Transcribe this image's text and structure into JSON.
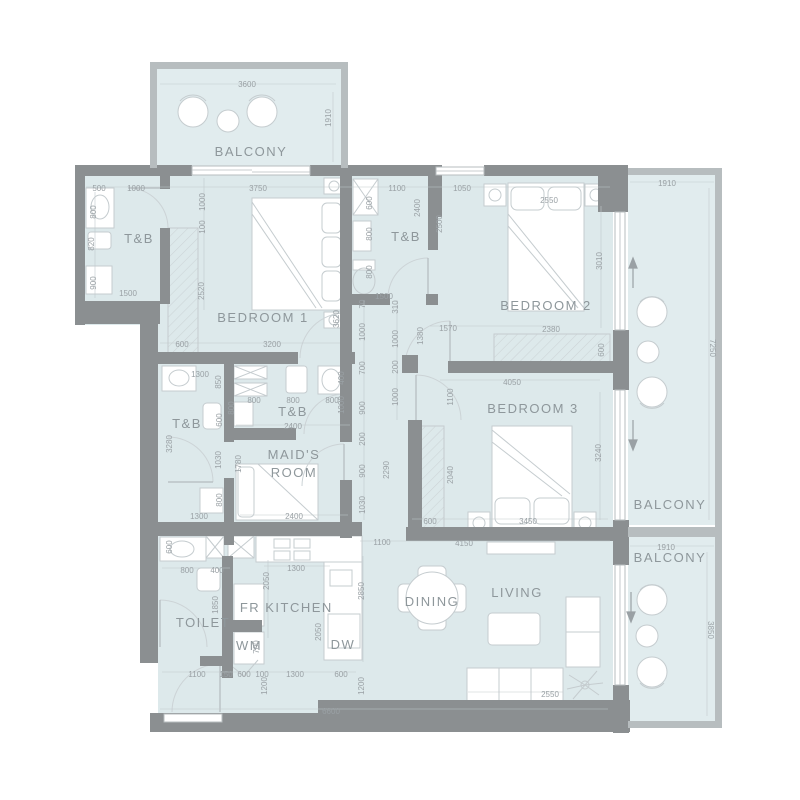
{
  "title": "apartment-floor-plan",
  "colors": {
    "wall": "#8b8f91",
    "balcony_wall": "#b7bdbf",
    "room_fill": "#dde9eb",
    "furniture_line": "#c5cccf",
    "dimension_text": "#9aa1a5",
    "room_label_text": "#8e979b"
  },
  "plan": {
    "rooms": [
      {
        "id": "balcony-top",
        "label": "BALCONY",
        "x": 251,
        "y": 156
      },
      {
        "id": "tb-1",
        "label": "T&B",
        "x": 139,
        "y": 243
      },
      {
        "id": "bedroom-1",
        "label": "BEDROOM 1",
        "x": 263,
        "y": 322
      },
      {
        "id": "tb-2",
        "label": "T&B",
        "x": 406,
        "y": 241
      },
      {
        "id": "bedroom-2",
        "label": "BEDROOM 2",
        "x": 546,
        "y": 310
      },
      {
        "id": "balcony-right",
        "label": "BALCONY",
        "x": 670,
        "y": 509
      },
      {
        "id": "tb-3",
        "label": "T&B",
        "x": 187,
        "y": 428
      },
      {
        "id": "tb-4",
        "label": "T&B",
        "x": 293,
        "y": 416
      },
      {
        "id": "maids-room-line1",
        "label": "MAID'S",
        "x": 294,
        "y": 459
      },
      {
        "id": "maids-room-line2",
        "label": "ROOM",
        "x": 294,
        "y": 477
      },
      {
        "id": "bedroom-3",
        "label": "BEDROOM 3",
        "x": 533,
        "y": 413
      },
      {
        "id": "balcony-bottom",
        "label": "BALCONY",
        "x": 670,
        "y": 562
      },
      {
        "id": "toilet",
        "label": "TOILET",
        "x": 203,
        "y": 627
      },
      {
        "id": "fr",
        "label": "FR",
        "x": 250,
        "y": 612
      },
      {
        "id": "kitchen",
        "label": "KITCHEN",
        "x": 299,
        "y": 612
      },
      {
        "id": "wm",
        "label": "WM",
        "x": 249,
        "y": 650
      },
      {
        "id": "dw",
        "label": "DW",
        "x": 343,
        "y": 649
      },
      {
        "id": "dining",
        "label": "DINING",
        "x": 432,
        "y": 606
      },
      {
        "id": "living",
        "label": "LIVING",
        "x": 517,
        "y": 597
      }
    ],
    "dimensions": [
      {
        "v": "3600",
        "x": 247,
        "y": 84,
        "o": "h"
      },
      {
        "v": "1910",
        "x": 331,
        "y": 118,
        "o": "v"
      },
      {
        "v": "500",
        "x": 99,
        "y": 188,
        "o": "h"
      },
      {
        "v": "1000",
        "x": 136,
        "y": 188,
        "o": "h"
      },
      {
        "v": "3750",
        "x": 258,
        "y": 188,
        "o": "h"
      },
      {
        "v": "800",
        "x": 96,
        "y": 212,
        "o": "v"
      },
      {
        "v": "820",
        "x": 94,
        "y": 244,
        "o": "v"
      },
      {
        "v": "900",
        "x": 96,
        "y": 283,
        "o": "v"
      },
      {
        "v": "1500",
        "x": 128,
        "y": 293,
        "o": "h"
      },
      {
        "v": "1000",
        "x": 205,
        "y": 202,
        "o": "v"
      },
      {
        "v": "100",
        "x": 205,
        "y": 227,
        "o": "v"
      },
      {
        "v": "2520",
        "x": 204,
        "y": 291,
        "o": "v"
      },
      {
        "v": "600",
        "x": 182,
        "y": 344,
        "o": "h"
      },
      {
        "v": "3200",
        "x": 272,
        "y": 344,
        "o": "h"
      },
      {
        "v": "3620",
        "x": 339,
        "y": 319,
        "o": "v"
      },
      {
        "v": "1100",
        "x": 397,
        "y": 188,
        "o": "h"
      },
      {
        "v": "1050",
        "x": 462,
        "y": 188,
        "o": "h"
      },
      {
        "v": "2550",
        "x": 549,
        "y": 200,
        "o": "h"
      },
      {
        "v": "600",
        "x": 372,
        "y": 203,
        "o": "v"
      },
      {
        "v": "800",
        "x": 372,
        "y": 234,
        "o": "v"
      },
      {
        "v": "800",
        "x": 372,
        "y": 272,
        "o": "v"
      },
      {
        "v": "1500",
        "x": 384,
        "y": 296,
        "o": "h"
      },
      {
        "v": "2400",
        "x": 420,
        "y": 208,
        "o": "v"
      },
      {
        "v": "2500",
        "x": 442,
        "y": 224,
        "o": "v"
      },
      {
        "v": "3010",
        "x": 602,
        "y": 261,
        "o": "v"
      },
      {
        "v": "2380",
        "x": 551,
        "y": 329,
        "o": "h"
      },
      {
        "v": "600",
        "x": 604,
        "y": 350,
        "o": "v"
      },
      {
        "v": "1570",
        "x": 448,
        "y": 328,
        "o": "h"
      },
      {
        "v": "1380",
        "x": 423,
        "y": 336,
        "o": "v"
      },
      {
        "v": "4050",
        "x": 512,
        "y": 382,
        "o": "h"
      },
      {
        "v": "70",
        "x": 365,
        "y": 304,
        "o": "v"
      },
      {
        "v": "1000",
        "x": 365,
        "y": 332,
        "o": "v"
      },
      {
        "v": "700",
        "x": 365,
        "y": 368,
        "o": "v"
      },
      {
        "v": "900",
        "x": 365,
        "y": 408,
        "o": "v"
      },
      {
        "v": "200",
        "x": 365,
        "y": 439,
        "o": "v"
      },
      {
        "v": "900",
        "x": 365,
        "y": 471,
        "o": "v"
      },
      {
        "v": "1030",
        "x": 365,
        "y": 505,
        "o": "v"
      },
      {
        "v": "310",
        "x": 398,
        "y": 307,
        "o": "v"
      },
      {
        "v": "1000",
        "x": 398,
        "y": 339,
        "o": "v"
      },
      {
        "v": "200",
        "x": 398,
        "y": 367,
        "o": "v"
      },
      {
        "v": "1000",
        "x": 398,
        "y": 397,
        "o": "v"
      },
      {
        "v": "2290",
        "x": 389,
        "y": 470,
        "o": "v"
      },
      {
        "v": "400",
        "x": 344,
        "y": 378,
        "o": "v"
      },
      {
        "v": "1000",
        "x": 344,
        "y": 405,
        "o": "v"
      },
      {
        "v": "1100",
        "x": 453,
        "y": 397,
        "o": "v"
      },
      {
        "v": "2040",
        "x": 453,
        "y": 475,
        "o": "v"
      },
      {
        "v": "1300",
        "x": 200,
        "y": 374,
        "o": "h"
      },
      {
        "v": "850",
        "x": 221,
        "y": 382,
        "o": "v"
      },
      {
        "v": "600",
        "x": 222,
        "y": 420,
        "o": "v"
      },
      {
        "v": "1030",
        "x": 221,
        "y": 460,
        "o": "v"
      },
      {
        "v": "800",
        "x": 222,
        "y": 500,
        "o": "v"
      },
      {
        "v": "1300",
        "x": 199,
        "y": 516,
        "o": "h"
      },
      {
        "v": "3280",
        "x": 172,
        "y": 444,
        "o": "v"
      },
      {
        "v": "1780",
        "x": 241,
        "y": 464,
        "o": "v"
      },
      {
        "v": "800",
        "x": 254,
        "y": 400,
        "o": "h"
      },
      {
        "v": "800",
        "x": 293,
        "y": 400,
        "o": "h"
      },
      {
        "v": "800",
        "x": 332,
        "y": 400,
        "o": "h"
      },
      {
        "v": "2400",
        "x": 293,
        "y": 426,
        "o": "h"
      },
      {
        "v": "800",
        "x": 234,
        "y": 408,
        "o": "v"
      },
      {
        "v": "2400",
        "x": 294,
        "y": 516,
        "o": "h"
      },
      {
        "v": "600",
        "x": 430,
        "y": 521,
        "o": "h"
      },
      {
        "v": "3450",
        "x": 528,
        "y": 521,
        "o": "h"
      },
      {
        "v": "3240",
        "x": 601,
        "y": 453,
        "o": "v"
      },
      {
        "v": "1100",
        "x": 382,
        "y": 542,
        "o": "h"
      },
      {
        "v": "4150",
        "x": 464,
        "y": 543,
        "o": "h"
      },
      {
        "v": "1910",
        "x": 667,
        "y": 183,
        "o": "h"
      },
      {
        "v": "7250",
        "x": 710,
        "y": 348,
        "o": "vr"
      },
      {
        "v": "1910",
        "x": 666,
        "y": 547,
        "o": "h"
      },
      {
        "v": "3850",
        "x": 708,
        "y": 630,
        "o": "vr"
      },
      {
        "v": "600",
        "x": 172,
        "y": 547,
        "o": "v"
      },
      {
        "v": "800",
        "x": 187,
        "y": 570,
        "o": "h"
      },
      {
        "v": "400",
        "x": 217,
        "y": 570,
        "o": "h"
      },
      {
        "v": "1850",
        "x": 218,
        "y": 605,
        "o": "v"
      },
      {
        "v": "2050",
        "x": 269,
        "y": 581,
        "o": "v"
      },
      {
        "v": "1300",
        "x": 296,
        "y": 568,
        "o": "h"
      },
      {
        "v": "2850",
        "x": 364,
        "y": 591,
        "o": "v"
      },
      {
        "v": "2050",
        "x": 321,
        "y": 632,
        "o": "v"
      },
      {
        "v": "700",
        "x": 259,
        "y": 647,
        "o": "v"
      },
      {
        "v": "1100",
        "x": 197,
        "y": 674,
        "o": "h"
      },
      {
        "v": "150",
        "x": 226,
        "y": 674,
        "o": "h"
      },
      {
        "v": "600",
        "x": 244,
        "y": 674,
        "o": "h"
      },
      {
        "v": "100",
        "x": 262,
        "y": 674,
        "o": "h"
      },
      {
        "v": "1300",
        "x": 295,
        "y": 674,
        "o": "h"
      },
      {
        "v": "600",
        "x": 341,
        "y": 674,
        "o": "h"
      },
      {
        "v": "1200",
        "x": 267,
        "y": 686,
        "o": "v"
      },
      {
        "v": "1200",
        "x": 364,
        "y": 686,
        "o": "v"
      },
      {
        "v": "6600",
        "x": 331,
        "y": 711,
        "o": "h"
      },
      {
        "v": "2550",
        "x": 550,
        "y": 694,
        "o": "h"
      }
    ]
  }
}
